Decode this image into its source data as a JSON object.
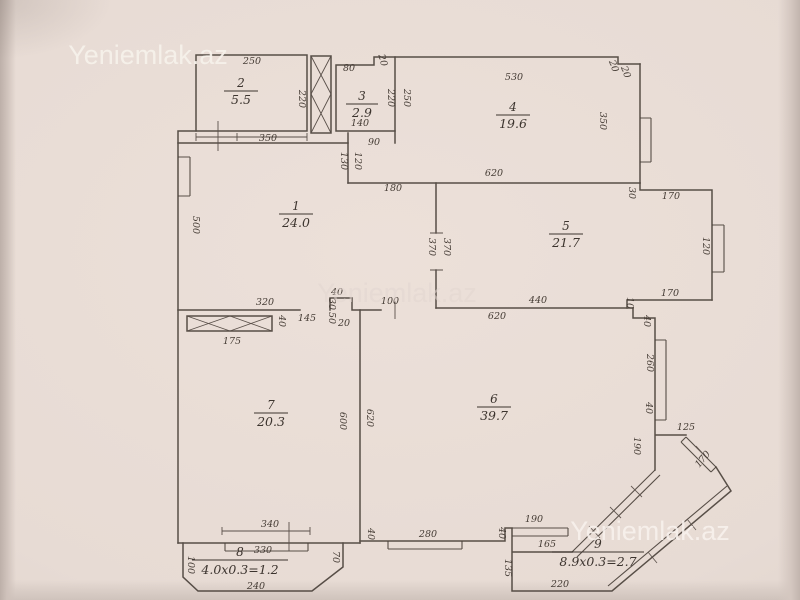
{
  "plan": {
    "watermarks": [
      {
        "text": "Yeniemlak.az"
      },
      {
        "text": "Yeniemlak.az"
      },
      {
        "text": "Yeniemlak.az"
      }
    ],
    "rooms": [
      {
        "number": "1",
        "area": "24.0"
      },
      {
        "number": "2",
        "area": "5.5"
      },
      {
        "number": "3",
        "area": "2.9"
      },
      {
        "number": "4",
        "area": "19.6"
      },
      {
        "number": "5",
        "area": "21.7"
      },
      {
        "number": "6",
        "area": "39.7"
      },
      {
        "number": "7",
        "area": "20.3"
      },
      {
        "number": "8",
        "area": "4.0x0.3=1.2"
      },
      {
        "number": "9",
        "area": "8.9x0.3=2.7"
      }
    ],
    "dimensions": [
      {
        "t": "250",
        "x": 252,
        "y": 64,
        "r": 0
      },
      {
        "t": "220",
        "x": 299,
        "y": 99,
        "r": 90
      },
      {
        "t": "350",
        "x": 268,
        "y": 141,
        "r": 0
      },
      {
        "t": "80",
        "x": 349,
        "y": 71,
        "r": 0
      },
      {
        "t": "20",
        "x": 380,
        "y": 61,
        "r": 75
      },
      {
        "t": "220",
        "x": 388,
        "y": 98,
        "r": 90
      },
      {
        "t": "250",
        "x": 404,
        "y": 98,
        "r": 90
      },
      {
        "t": "140",
        "x": 360,
        "y": 126,
        "r": 0
      },
      {
        "t": "90",
        "x": 374,
        "y": 145,
        "r": 0
      },
      {
        "t": "130",
        "x": 341,
        "y": 161,
        "r": 90
      },
      {
        "t": "120",
        "x": 355,
        "y": 161,
        "r": 90
      },
      {
        "t": "180",
        "x": 393,
        "y": 191,
        "r": 0
      },
      {
        "t": "530",
        "x": 514,
        "y": 80,
        "r": 0
      },
      {
        "t": "20",
        "x": 611,
        "y": 67,
        "r": 70
      },
      {
        "t": "20",
        "x": 623,
        "y": 73,
        "r": 70
      },
      {
        "t": "350",
        "x": 600,
        "y": 121,
        "r": 90
      },
      {
        "t": "620",
        "x": 494,
        "y": 176,
        "r": 0
      },
      {
        "t": "30",
        "x": 629,
        "y": 193,
        "r": 90
      },
      {
        "t": "170",
        "x": 671,
        "y": 199,
        "r": 0
      },
      {
        "t": "370",
        "x": 429,
        "y": 247,
        "r": 90
      },
      {
        "t": "370",
        "x": 444,
        "y": 247,
        "r": 90
      },
      {
        "t": "120",
        "x": 703,
        "y": 246,
        "r": 90
      },
      {
        "t": "170",
        "x": 670,
        "y": 296,
        "r": 0
      },
      {
        "t": "500",
        "x": 193,
        "y": 225,
        "r": 90
      },
      {
        "t": "320",
        "x": 265,
        "y": 305,
        "r": 0
      },
      {
        "t": "40",
        "x": 337,
        "y": 295,
        "r": 0
      },
      {
        "t": "30",
        "x": 329,
        "y": 304,
        "r": 90
      },
      {
        "t": "145",
        "x": 307,
        "y": 321,
        "r": 0
      },
      {
        "t": "50",
        "x": 329,
        "y": 318,
        "r": 90
      },
      {
        "t": "20",
        "x": 344,
        "y": 326,
        "r": 0
      },
      {
        "t": "100",
        "x": 390,
        "y": 304,
        "r": 0
      },
      {
        "t": "440",
        "x": 538,
        "y": 303,
        "r": 0
      },
      {
        "t": "10",
        "x": 627,
        "y": 303,
        "r": 90
      },
      {
        "t": "620",
        "x": 497,
        "y": 319,
        "r": 0
      },
      {
        "t": "40",
        "x": 644,
        "y": 321,
        "r": 90
      },
      {
        "t": "40",
        "x": 279,
        "y": 321,
        "r": 90
      },
      {
        "t": "175",
        "x": 232,
        "y": 344,
        "r": 0
      },
      {
        "t": "600",
        "x": 340,
        "y": 421,
        "r": 90
      },
      {
        "t": "620",
        "x": 367,
        "y": 418,
        "r": 90
      },
      {
        "t": "260",
        "x": 647,
        "y": 363,
        "r": 90
      },
      {
        "t": "40",
        "x": 646,
        "y": 408,
        "r": 90
      },
      {
        "t": "190",
        "x": 634,
        "y": 446,
        "r": 90
      },
      {
        "t": "125",
        "x": 686,
        "y": 430,
        "r": 0
      },
      {
        "t": "170",
        "x": 705,
        "y": 461,
        "r": -50
      },
      {
        "t": "340",
        "x": 270,
        "y": 527,
        "r": 0
      },
      {
        "t": "330",
        "x": 263,
        "y": 553,
        "r": 0
      },
      {
        "t": "240",
        "x": 256,
        "y": 589,
        "r": 0
      },
      {
        "t": "100",
        "x": 188,
        "y": 565,
        "r": 90
      },
      {
        "t": "70",
        "x": 333,
        "y": 557,
        "r": 90
      },
      {
        "t": "40",
        "x": 368,
        "y": 534,
        "r": 90
      },
      {
        "t": "280",
        "x": 428,
        "y": 537,
        "r": 0
      },
      {
        "t": "40",
        "x": 499,
        "y": 533,
        "r": 90
      },
      {
        "t": "190",
        "x": 534,
        "y": 522,
        "r": 0
      },
      {
        "t": "165",
        "x": 547,
        "y": 547,
        "r": 0
      },
      {
        "t": "135",
        "x": 505,
        "y": 568,
        "r": 90
      },
      {
        "t": "220",
        "x": 560,
        "y": 587,
        "r": 0
      }
    ]
  }
}
